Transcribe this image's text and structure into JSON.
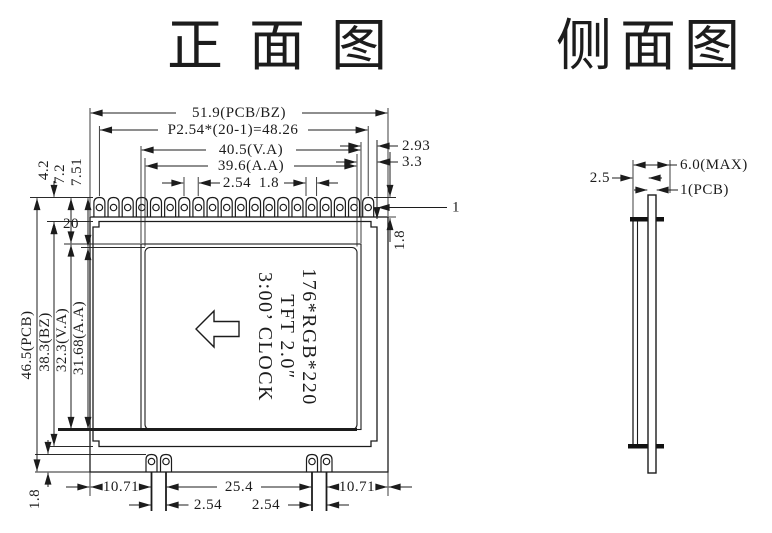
{
  "titles": {
    "front": "正面图",
    "side": "侧面图"
  },
  "front": {
    "pin_count": 20,
    "display": {
      "line1": "176*RGB*220",
      "line2": "TFT  2.0″",
      "line3": "3:00’ CLOCK"
    },
    "dims": {
      "width_total": "51.9(PCB/BZ)",
      "pitch_total": "P2.54*(20-1)=48.26",
      "width_va": "40.5(V.A)",
      "width_aa": "39.6(A.A)",
      "pitch": "2.54",
      "pad_width": "1.8",
      "margin_va_right": "2.93",
      "margin_aa_right": "3.3",
      "pin_first": "1",
      "pin_last": "20",
      "pin_row_height": "1.8",
      "top_margin_bz": "4.2",
      "top_margin_va": "7.2",
      "top_margin_aa": "7.51",
      "height_pcb": "46.5(PCB)",
      "height_bz": "38.3(BZ)",
      "height_va": "32.3(V.A)",
      "height_aa": "31.68(A.A)",
      "bottom_offset_left": "10.71",
      "bottom_span_center": "25.4",
      "bottom_offset_right": "10.71",
      "bottom_pitch_left": "2.54",
      "bottom_pitch_right": "2.54",
      "bottom_margin": "1.8"
    }
  },
  "side": {
    "dims": {
      "offset": "2.5",
      "total_thickness": "6.0(MAX)",
      "pcb_thickness": "1(PCB)"
    }
  }
}
